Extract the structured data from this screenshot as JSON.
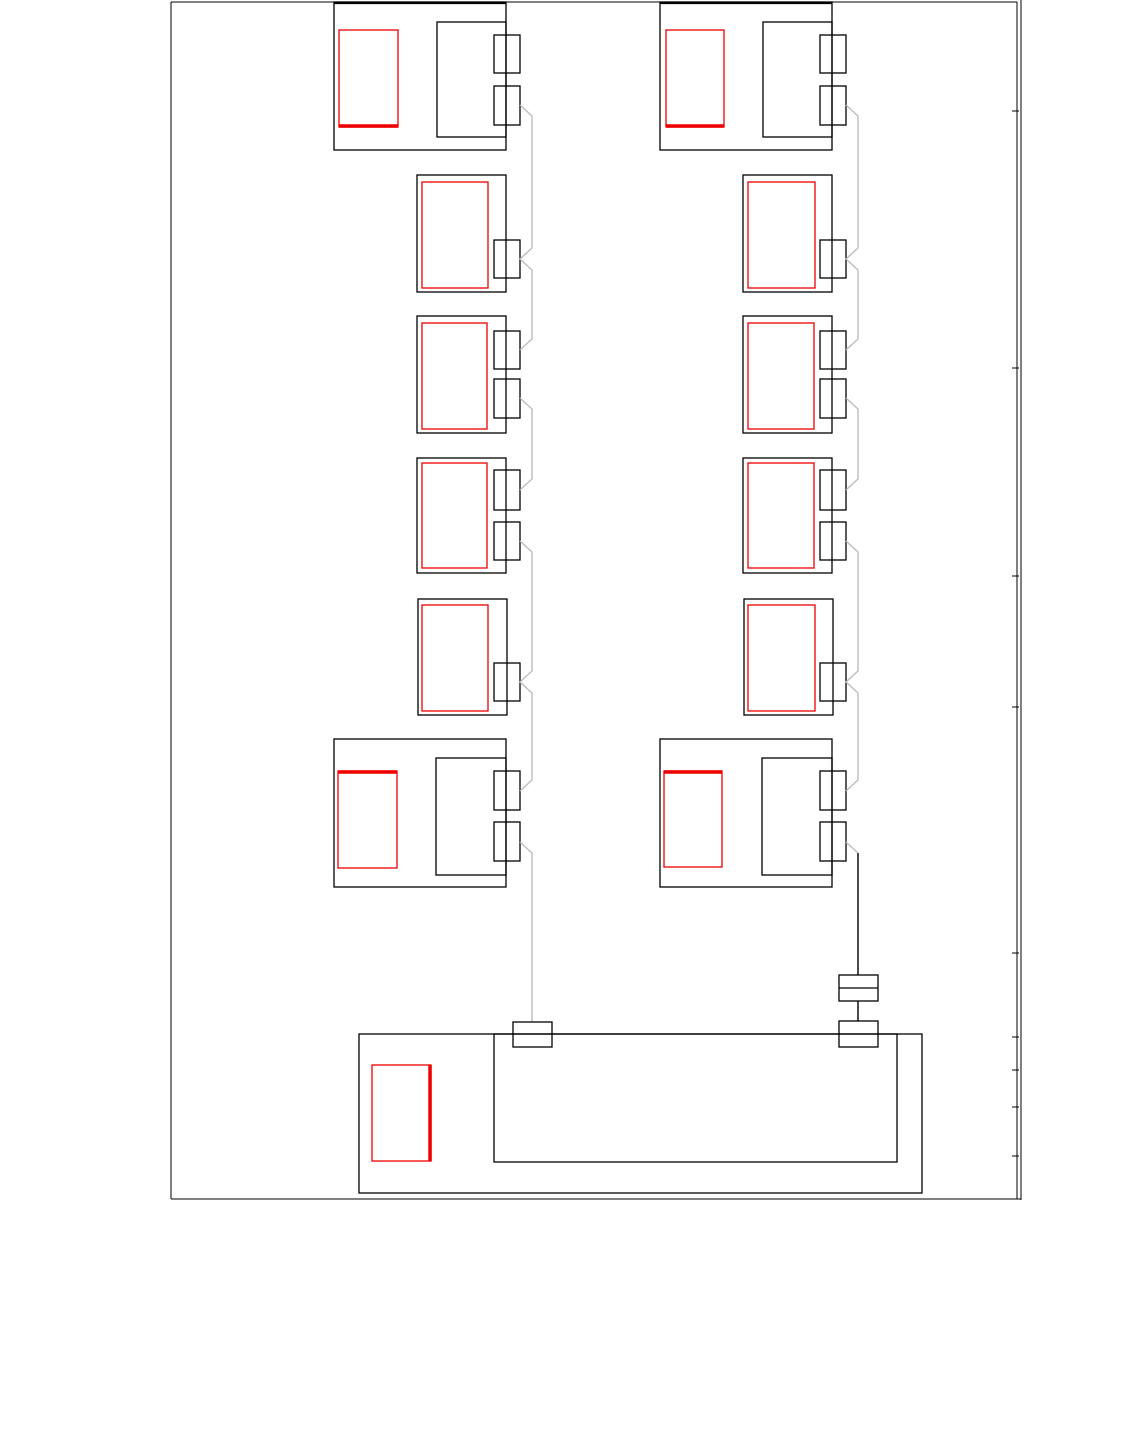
{
  "canvas": {
    "width": 1134,
    "height": 1443,
    "background": "#ffffff"
  },
  "palette": {
    "line": "#000000",
    "red": "#ee0000",
    "wire_gray": "#bdbdbd",
    "wire_black": "#000000"
  },
  "page_frame": {
    "lines": [
      {
        "name": "page-border-top",
        "d": "M171,2 L1017,2"
      },
      {
        "name": "page-border-left",
        "d": "M171,2 L171,1199"
      },
      {
        "name": "page-border-bottom",
        "d": "M171,1199 L1021,1199"
      },
      {
        "name": "page-border-right-inner",
        "d": "M1017,2 L1017,1199"
      },
      {
        "name": "page-border-right-outer",
        "d": "M1021,0 L1021,1200"
      }
    ],
    "tick_x1": 1012,
    "tick_x2": 1019,
    "tick_ys": [
      111,
      368,
      576,
      707,
      953,
      1037,
      1070,
      1107,
      1156
    ]
  },
  "modules": [
    {
      "name": "module-left-row1",
      "thick_top": true,
      "outer": [
        334,
        2,
        172,
        148
      ],
      "red": [
        339,
        30,
        59,
        97
      ],
      "red_thick_edge": "bottom",
      "inner": [
        437,
        22,
        69,
        115
      ],
      "tabs": [
        [
          494,
          35,
          26,
          38
        ],
        [
          494,
          86,
          26,
          39
        ]
      ]
    },
    {
      "name": "module-left-row2",
      "outer": [
        417,
        175,
        89,
        117
      ],
      "red": [
        422,
        182,
        66,
        106
      ],
      "tabs": [
        [
          494,
          240,
          26,
          38
        ]
      ]
    },
    {
      "name": "module-left-row3",
      "outer": [
        417,
        316,
        89,
        117
      ],
      "red": [
        422,
        323,
        65,
        106
      ],
      "tabs": [
        [
          494,
          331,
          26,
          38
        ],
        [
          494,
          379,
          26,
          39
        ]
      ]
    },
    {
      "name": "module-left-row4",
      "outer": [
        417,
        458,
        89,
        115
      ],
      "red": [
        422,
        463,
        65,
        105
      ],
      "tabs": [
        [
          494,
          470,
          26,
          40
        ],
        [
          494,
          522,
          26,
          38
        ]
      ]
    },
    {
      "name": "module-left-row5",
      "outer": [
        418,
        599,
        89,
        116
      ],
      "red": [
        422,
        605,
        66,
        106
      ],
      "tabs": [
        [
          494,
          663,
          26,
          38
        ]
      ]
    },
    {
      "name": "module-left-row6",
      "outer": [
        334,
        739,
        172,
        148
      ],
      "red": [
        338,
        771,
        59,
        97
      ],
      "red_thick_edge": "top",
      "inner": [
        436,
        758,
        70,
        117
      ],
      "tabs": [
        [
          494,
          771,
          26,
          39
        ],
        [
          494,
          822,
          26,
          39
        ]
      ]
    },
    {
      "name": "module-right-row1",
      "thick_top": true,
      "outer": [
        660,
        2,
        172,
        148
      ],
      "red": [
        666,
        30,
        58,
        97
      ],
      "red_thick_edge": "bottom",
      "inner": [
        763,
        22,
        69,
        115
      ],
      "tabs": [
        [
          820,
          35,
          26,
          38
        ],
        [
          820,
          86,
          26,
          39
        ]
      ]
    },
    {
      "name": "module-right-row2",
      "outer": [
        743,
        175,
        89,
        117
      ],
      "red": [
        748,
        182,
        67,
        106
      ],
      "tabs": [
        [
          820,
          240,
          26,
          38
        ]
      ]
    },
    {
      "name": "module-right-row3",
      "outer": [
        743,
        316,
        89,
        117
      ],
      "red": [
        748,
        323,
        66,
        106
      ],
      "tabs": [
        [
          820,
          331,
          26,
          38
        ],
        [
          820,
          379,
          26,
          39
        ]
      ]
    },
    {
      "name": "module-right-row4",
      "outer": [
        743,
        458,
        89,
        115
      ],
      "red": [
        748,
        463,
        66,
        105
      ],
      "tabs": [
        [
          820,
          470,
          26,
          40
        ],
        [
          820,
          522,
          26,
          38
        ]
      ]
    },
    {
      "name": "module-right-row5",
      "outer": [
        744,
        599,
        89,
        116
      ],
      "red": [
        748,
        605,
        67,
        106
      ],
      "tabs": [
        [
          820,
          663,
          26,
          38
        ]
      ]
    },
    {
      "name": "module-right-row6",
      "outer": [
        660,
        739,
        172,
        148
      ],
      "red": [
        664,
        771,
        58,
        96
      ],
      "red_thick_edge": "top",
      "inner": [
        762,
        758,
        70,
        117
      ],
      "tabs": [
        [
          820,
          771,
          26,
          39
        ],
        [
          820,
          822,
          26,
          39
        ]
      ]
    },
    {
      "name": "module-bottom-controller",
      "outer": [
        359,
        1034,
        563,
        159
      ],
      "inner": [
        494,
        1034,
        403,
        128
      ],
      "red": [
        372,
        1065,
        59,
        96
      ],
      "red_thick_edge": "right"
    }
  ],
  "connectors": [
    {
      "name": "splice-left-bus",
      "rect": [
        513,
        1022,
        39,
        25
      ]
    },
    {
      "name": "splice-right-inline",
      "rect": [
        839,
        975,
        39,
        26
      ],
      "divider_y": 988
    },
    {
      "name": "splice-right-bus",
      "rect": [
        839,
        1021,
        39,
        26
      ]
    }
  ],
  "wires": [
    {
      "name": "left-bus-segment-1",
      "color": "gray",
      "d": "M520,105 L532,116 L532,248 L520,259 L532,270 L532,339 L520,350"
    },
    {
      "name": "left-bus-segment-2",
      "color": "gray",
      "d": "M520,398 L532,409 L532,479 L520,490"
    },
    {
      "name": "left-bus-segment-3",
      "color": "gray",
      "d": "M520,541 L532,552 L532,671 L520,682 L532,693 L532,780 L520,791"
    },
    {
      "name": "left-bus-segment-4",
      "color": "gray",
      "d": "M520,842 L532,853 L532,1022"
    },
    {
      "name": "right-bus-segment-1",
      "color": "gray",
      "d": "M846,105 L858,116 L858,248 L846,259 L858,270 L858,339 L846,350"
    },
    {
      "name": "right-bus-segment-2",
      "color": "gray",
      "d": "M846,398 L858,409 L858,479 L846,490"
    },
    {
      "name": "right-bus-segment-3",
      "color": "gray",
      "d": "M846,541 L858,552 L858,671 L846,682 L858,693 L858,780 L846,791"
    },
    {
      "name": "right-bus-segment-4",
      "color": "gray",
      "d": "M846,842 L858,853"
    },
    {
      "name": "right-bus-drop",
      "color": "black",
      "d": "M858,853 L858,975"
    },
    {
      "name": "right-bus-link",
      "color": "black",
      "d": "M858,1001 L858,1021"
    }
  ],
  "stroke": {
    "page": 1.0,
    "tick": 1.0,
    "module": 1.3,
    "module_thick_top": 2.6,
    "red": 1.3,
    "red_thick": 3.4,
    "wire": 1.4
  }
}
